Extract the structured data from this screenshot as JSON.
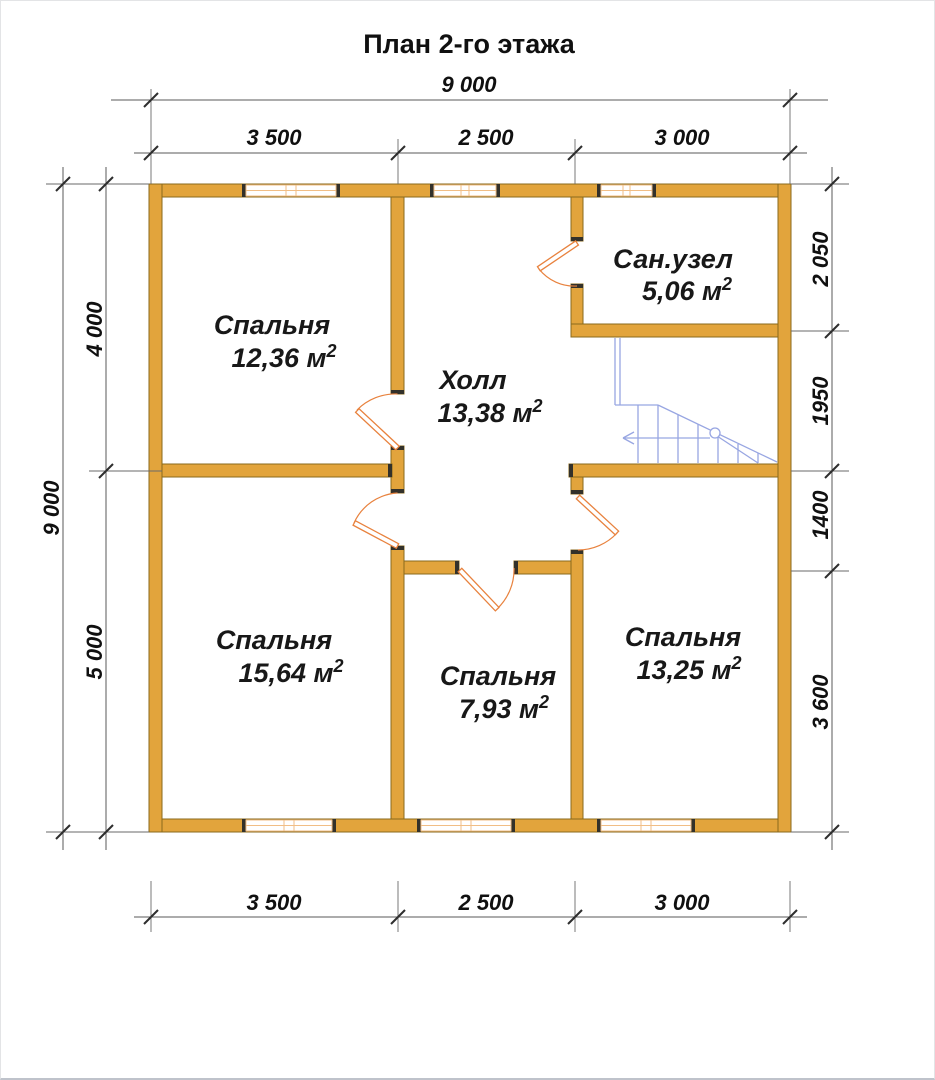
{
  "title": "План 2-го этажа",
  "rooms": [
    {
      "name": "Спальня",
      "area": "12,36 м",
      "area_sup": "2"
    },
    {
      "name": "Холл",
      "area": "13,38 м",
      "area_sup": "2"
    },
    {
      "name": "Сан.узел",
      "area": "5,06 м",
      "area_sup": "2"
    },
    {
      "name": "Спальня",
      "area": "15,64 м",
      "area_sup": "2"
    },
    {
      "name": "Спальня",
      "area": "7,93 м",
      "area_sup": "2"
    },
    {
      "name": "Спальня",
      "area": "13,25 м",
      "area_sup": "2"
    }
  ],
  "dimensions": {
    "top_total": "9 000",
    "top_segments": [
      "3 500",
      "2 500",
      "3 000"
    ],
    "bottom_segments": [
      "3 500",
      "2 500",
      "3 000"
    ],
    "left_total": "9 000",
    "left_upper": "4 000",
    "left_lower": "5 000",
    "right_1": "2 050",
    "right_2": "1950",
    "right_3": "1400",
    "right_4": "3 600"
  },
  "colors": {
    "wall": "#E2A43C",
    "wall_cap": "#33312a",
    "window_frame": "#F1BE86",
    "door": "#E8823E",
    "stairs": "#98A6E2",
    "dimension": "#5a5a5a",
    "text": "#101010"
  }
}
